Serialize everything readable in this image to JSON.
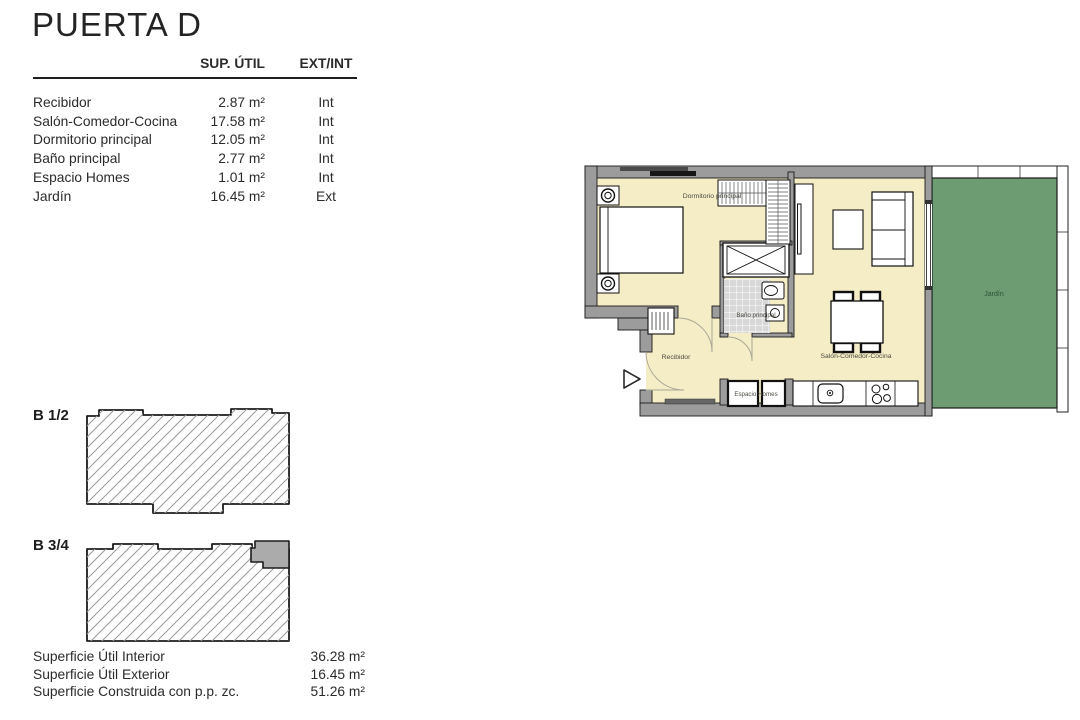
{
  "title": "PUERTA D",
  "areas_table": {
    "col_area": "SUP. ÚTIL",
    "col_type": "EXT/INT",
    "rows": [
      {
        "room": "Recibidor",
        "area": "2.87 m²",
        "type": "Int"
      },
      {
        "room": "Salón-Comedor-Cocina",
        "area": "17.58 m²",
        "type": "Int"
      },
      {
        "room": "Dormitorio principal",
        "area": "12.05 m²",
        "type": "Int"
      },
      {
        "room": "Baño principal",
        "area": "2.77 m²",
        "type": "Int"
      },
      {
        "room": "Espacio Homes",
        "area": "1.01 m²",
        "type": "Int"
      },
      {
        "room": "Jardín",
        "area": "16.45 m²",
        "type": "Ext"
      }
    ]
  },
  "summary": {
    "rows": [
      {
        "label": "Superficie Útil Interior",
        "value": "36.28 m²"
      },
      {
        "label": "Superficie Útil Exterior",
        "value": "16.45 m²"
      },
      {
        "label": "Superficie Construida con p.p. zc.",
        "value": "51.26 m²"
      }
    ]
  },
  "location_blocks": [
    {
      "label": "B 1/2",
      "has_highlighted_unit": false
    },
    {
      "label": "B 3/4",
      "has_highlighted_unit": true
    }
  ],
  "floorplan": {
    "room_labels": {
      "bedroom": "Dormitorio principal",
      "bathroom": "Baño principal",
      "hall": "Recibidor",
      "living_kitchen": "Salón-Comedor-Cocina",
      "storage": "Espacio Homes",
      "garden": "Jardín"
    },
    "colors": {
      "floor": "#f5edc6",
      "wall": "#9c9c9c",
      "garden": "#6d9c73",
      "bath_tile": "#d8d8d8",
      "highlight_unit": "#ababab"
    }
  }
}
